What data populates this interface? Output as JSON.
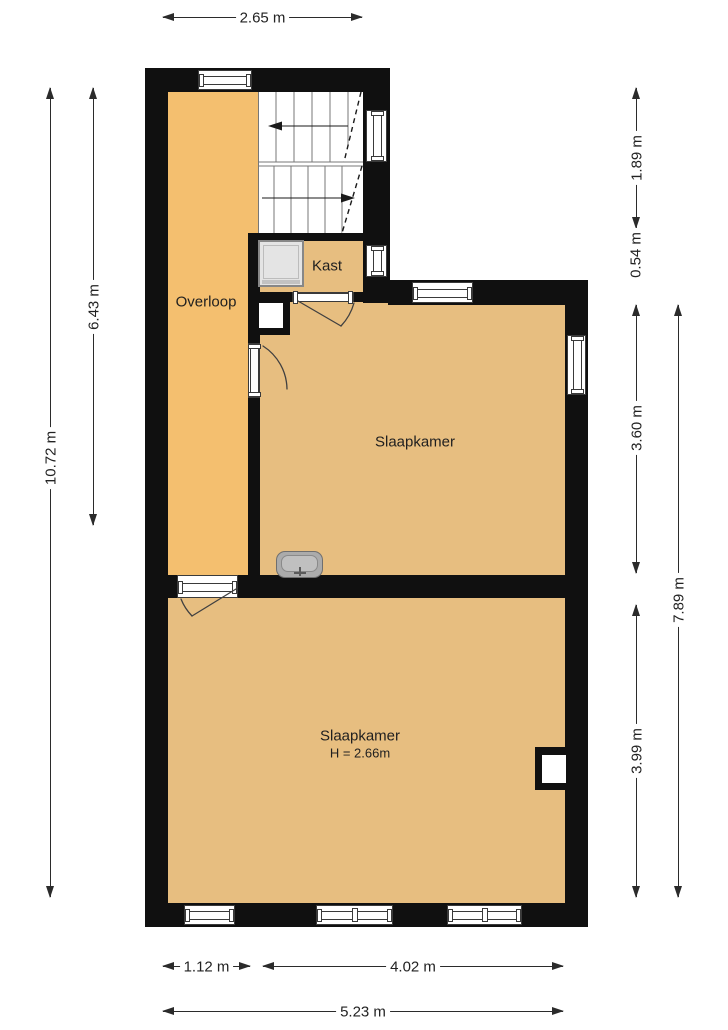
{
  "plan": {
    "rooms": {
      "overloop": {
        "label": "Overloop"
      },
      "kast": {
        "label": "Kast"
      },
      "bedroom_upper": {
        "label": "Slaapkamer"
      },
      "bedroom_lower": {
        "label": "Slaapkamer",
        "height_note": "H = 2.66m"
      }
    },
    "dimensions": {
      "top_width": "2.65 m",
      "left_upper": "6.43 m",
      "left_total": "10.72 m",
      "right_stairs": "1.89 m",
      "right_kast": "0.54 m",
      "right_bedroom_upper": "3.60 m",
      "right_total": "7.89 m",
      "right_bedroom_lower": "3.99 m",
      "bottom_left": "1.12 m",
      "bottom_right": "4.02 m",
      "bottom_total": "5.23 m"
    },
    "fixtures": {
      "stairs": "staircase-with-direction-arrows",
      "boiler": "boiler-unit",
      "sink": "wash-basin",
      "shaft_upper": "duct-shaft",
      "shaft_lower": "duct-shaft"
    },
    "colors": {
      "hallway_floor": "#F4BF6F",
      "room_floor": "#E7BE80",
      "wall": "#101010",
      "dimension_line": "#2B2B2B"
    }
  }
}
